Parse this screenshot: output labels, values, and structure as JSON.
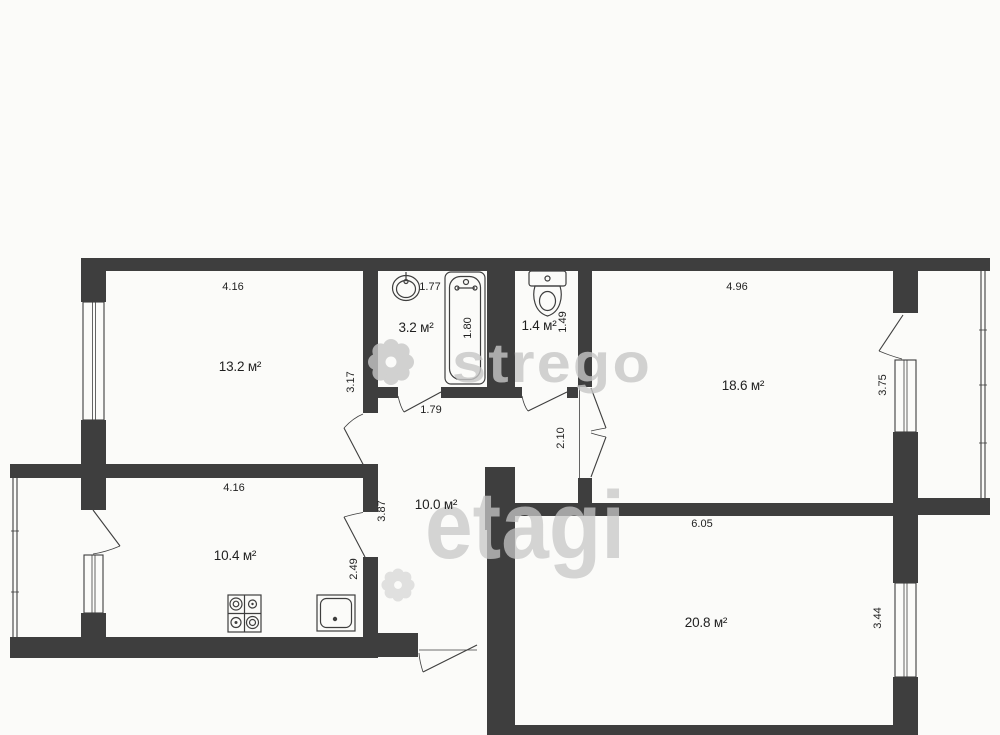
{
  "meta": {
    "type": "apartment-floor-plan"
  },
  "colors": {
    "wall": "#3e3e3e",
    "paper": "#fbfbf9",
    "ink": "#1f1f1f",
    "watermark": "#c7c7c7"
  },
  "rooms": {
    "room_13": "13.2 м²",
    "bath": "3.2 м²",
    "wc": "1.4 м²",
    "room_18": "18.6 м²",
    "hall": "10.0 м²",
    "kitchen": "10.4 м²",
    "room_20": "20.8 м²"
  },
  "dims": {
    "d416_top": "4.16",
    "d177": "1.77",
    "d180": "1.80",
    "d149": "1.49",
    "d496": "4.96",
    "d317": "3.17",
    "d179": "1.79",
    "d210": "2.10",
    "d375": "3.75",
    "d416_kitchen": "4.16",
    "d387": "3.87",
    "d249": "2.49",
    "d605": "6.05",
    "d344": "3.44"
  },
  "watermark": {
    "brand_top": "strego",
    "brand_center": "etagi"
  }
}
